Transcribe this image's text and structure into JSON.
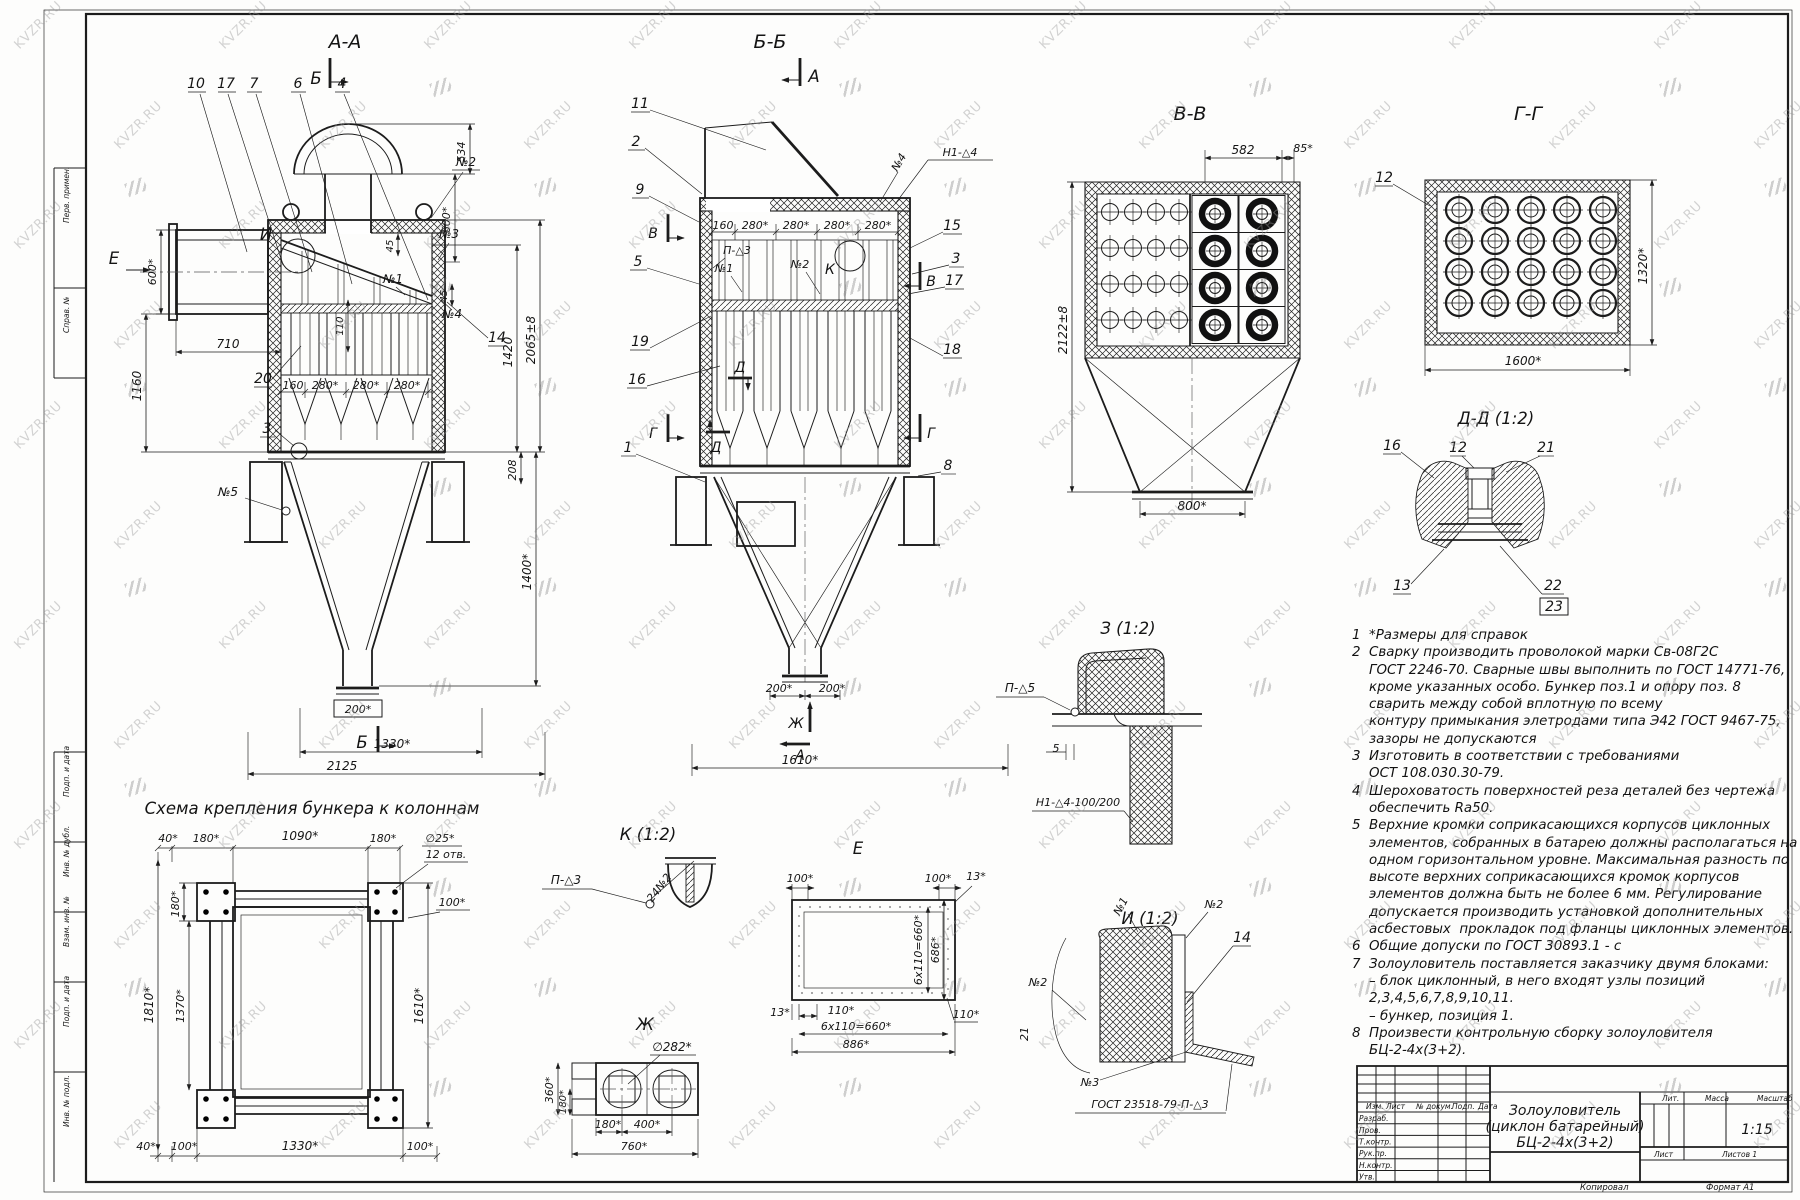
{
  "watermark": {
    "text": "KVZR.RU"
  },
  "stamps": [
    "Перв. примен.",
    "Справ. №",
    "Подп. и дата",
    "Инв. № дубл.",
    "Взам. инв. №",
    "Подп. и дата",
    "Инв. № подл."
  ],
  "aa": {
    "title": "А-А",
    "marker_top": "Б",
    "marker_bottom": "Б",
    "view_e": "Е",
    "detail_i": "И",
    "callouts": [
      "10",
      "17",
      "7",
      "6",
      "4"
    ],
    "pos_n1": "№1",
    "pos_n2": "№2",
    "pos_n3": "№3",
    "pos_n4": "№4",
    "pos_n5": "№5",
    "pos_3": "3",
    "pos_14": "14",
    "pos_20": "20",
    "dim_534": "534",
    "dim_600r": "600*",
    "dim_45a": "45",
    "dim_45b": "45",
    "dim_110": "110",
    "dim_2065": "2065±8",
    "dim_1420": "1420",
    "dim_600l": "600*",
    "dim_710": "710",
    "dim_1160": "1160",
    "dim_160": "160",
    "dim_280a": "280*",
    "dim_280b": "280*",
    "dim_280c": "280*",
    "dim_208": "208",
    "dim_1400": "1400*",
    "dim_200": "200*",
    "dim_1330": "1330*",
    "dim_2125": "2125"
  },
  "bb": {
    "title": "Б-Б",
    "marker_a_top": "А",
    "marker_a_bot": "А",
    "marker_v_l": "В",
    "marker_v_r": "В",
    "marker_g_l": "Г",
    "marker_g_r": "Г",
    "marker_d_top": "Д",
    "marker_d_bot": "Д",
    "marker_zh": "Ж",
    "callouts_left": [
      "11",
      "2",
      "9",
      "5",
      "19",
      "16"
    ],
    "callout_1": "1",
    "callouts_right": [
      "15",
      "3",
      "17",
      "18"
    ],
    "callout_8": "8",
    "weld_h1": "Н1-△4",
    "pos_n4": "№4",
    "weld_p3": "П-△3",
    "pos_n1": "№1",
    "pos_n2": "№2",
    "detail_k": "К",
    "dims_row": [
      "160",
      "280*",
      "280*",
      "280*",
      "280*"
    ],
    "dim_200a": "200*",
    "dim_200b": "200*",
    "dim_1610": "1610*"
  },
  "vv": {
    "title": "В-В",
    "dim_582": "582",
    "dim_85": "85*",
    "dim_2122": "2122±8",
    "dim_800": "800*"
  },
  "gg": {
    "title": "Г-Г",
    "pos_12": "12",
    "dim_1600": "1600*",
    "dim_1320": "1320*"
  },
  "dd": {
    "title": "Д-Д (1:2)",
    "pos_16": "16",
    "pos_12": "12",
    "pos_21": "21",
    "pos_13": "13",
    "pos_22": "22",
    "pos_23": "23"
  },
  "z": {
    "title": "З (1:2)",
    "weld": "П-△5",
    "dim_5": "5"
  },
  "k": {
    "title": "К (1:2)",
    "weld": "П-△3",
    "weld2": "24№2"
  },
  "e": {
    "title": "Е",
    "dim_100a": "100*",
    "dim_100b": "100*",
    "dim_13a": "13*",
    "dim_13b": "13*",
    "dim_110a": "110*",
    "dim_110b": "110*",
    "dim_660v": "6х110=660*",
    "dim_660h": "6х110=660*",
    "dim_686": "686*",
    "dim_886": "886*"
  },
  "zh": {
    "title": "Ж",
    "dim_d282": "∅282*",
    "dim_360": "360*",
    "dim_180v": "180*",
    "dim_180h": "180*",
    "dim_400": "400*",
    "dim_760": "760*"
  },
  "i": {
    "title": "И (1:2)",
    "weld": "Н1-△4-100/200",
    "pos_n1": "№1",
    "pos_n2a": "№2",
    "pos_14": "14",
    "pos_n2b": "№2",
    "pos_21": "21",
    "pos_n3": "№3",
    "gost": "ГОСТ 23518-79-П-△3"
  },
  "scheme": {
    "title": "Схема крепления бункера к колоннам",
    "dim_40t": "40*",
    "dim_180a": "180*",
    "dim_1090": "1090*",
    "dim_180b": "180*",
    "dia": "∅25*",
    "holes": "12 отв.",
    "dim_180l": "180*",
    "dim_100r": "100*",
    "dim_1810": "1810*",
    "dim_1370": "1370*",
    "dim_1610": "1610*",
    "dim_40b": "40*",
    "dim_100a": "100*",
    "dim_1330": "1330*",
    "dim_100b": "100*"
  },
  "notes": {
    "lines": [
      "1  *Размеры для справок",
      "2  Сварку производить проволокой марки Св-08Г2С",
      "    ГОСТ 2246-70. Сварные швы выполнить по ГОСТ 14771-76,",
      "    кроме указанных особо. Бункер поз.1 и опору поз. 8",
      "    сварить между собой вплотную по всему",
      "    контуру примыкания элетродами типа Э42 ГОСТ 9467-75,",
      "    зазоры не допускаются",
      "3  Изготовить в соответствии с требованиями",
      "    ОСТ 108.030.30-79.",
      "4  Шероховатость поверхностей реза деталей без чертежа",
      "    обеспечить Ra50.",
      "5  Верхние кромки соприкасающихся корпусов циклонных",
      "    элементов, собранных в батарею должны располагаться на",
      "    одном горизонтальном уровне. Максимальная разность по",
      "    высоте верхних соприкасающихся кромок корпусов",
      "    элементов должна быть не более 6 мм. Регулирование",
      "    допускается производить установкой дополнительных",
      "    асбестовых  прокладок под фланцы циклонных элементов.",
      "6  Общие допуски по ГОСТ 30893.1 - с",
      "7  Золоуловитель поставляется заказчику двумя блоками:",
      "    – блок циклонный, в него входят узлы позиций",
      "    2,3,4,5,6,7,8,9,10,11.",
      "    – бункер, позиция 1.",
      "8  Произвести контрольную сборку золоуловителя",
      "    БЦ-2-4х(3+2)."
    ]
  },
  "title_block": {
    "col_izm": "Изм.",
    "col_list": "Лист",
    "col_doc": "№ докум.",
    "col_sign": "Подп.",
    "col_date": "Дата",
    "rows": [
      "Разраб.",
      "Пров.",
      "Т.контр.",
      "Рук.пр.",
      "Н.контр.",
      "Утв."
    ],
    "title1": "Золоуловитель",
    "title2": "(циклон батарейный)",
    "title3": "БЦ-2-4х(3+2)",
    "lit": "Лит.",
    "mass": "Масса",
    "scale": "Масштаб",
    "scale_value": "1:15",
    "sheet": "Лист",
    "sheets": "Листов 1",
    "copy": "Копировал",
    "format": "Формат А1"
  }
}
